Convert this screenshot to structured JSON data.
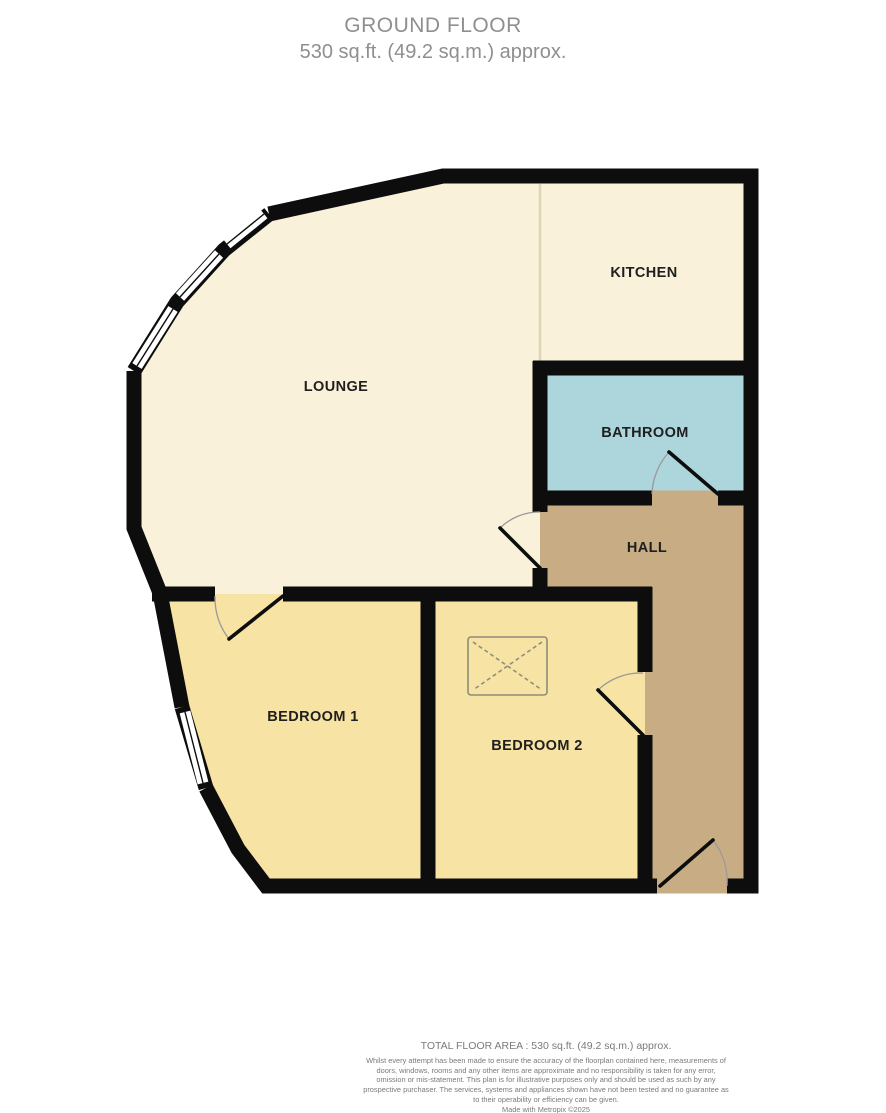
{
  "title": {
    "floor_name": "GROUND FLOOR",
    "area": "530 sq.ft. (49.2 sq.m.) approx."
  },
  "rooms": {
    "kitchen": {
      "label": "KITCHEN",
      "floor_color": "#f9f1d9"
    },
    "lounge": {
      "label": "LOUNGE",
      "floor_color": "#f9f1d9"
    },
    "bathroom": {
      "label": "BATHROOM",
      "floor_color": "#add5dc"
    },
    "hall": {
      "label": "HALL",
      "floor_color": "#c8ad84"
    },
    "bedroom1": {
      "label": "BEDROOM 1",
      "floor_color": "#f7e3a3"
    },
    "bedroom2": {
      "label": "BEDROOM 2",
      "floor_color": "#f7e3a3"
    }
  },
  "colors": {
    "wall": "#0d0d0d",
    "window_fill": "#ffffff",
    "door_arc": "#9a9a9a",
    "divider_line": "#ded5b8",
    "skylight_line": "#8d8d78",
    "title_text": "#8f8f8f",
    "label_text": "#1f1f1f",
    "footer_text": "#7a7a7a"
  },
  "footer": {
    "total_area": "TOTAL FLOOR AREA : 530 sq.ft. (49.2 sq.m.) approx.",
    "disclaimer": "Whilst every attempt has been made to ensure the accuracy of the floorplan contained here, measurements of doors, windows, rooms and any other items are approximate and no responsibility is taken for any error, omission or mis-statement. This plan is for illustrative purposes only and should be used as such by any prospective purchaser. The services, systems and appliances shown have not been tested and no guarantee as to their operability or efficiency can be given.",
    "credit": "Made with Metropix ©2025"
  }
}
